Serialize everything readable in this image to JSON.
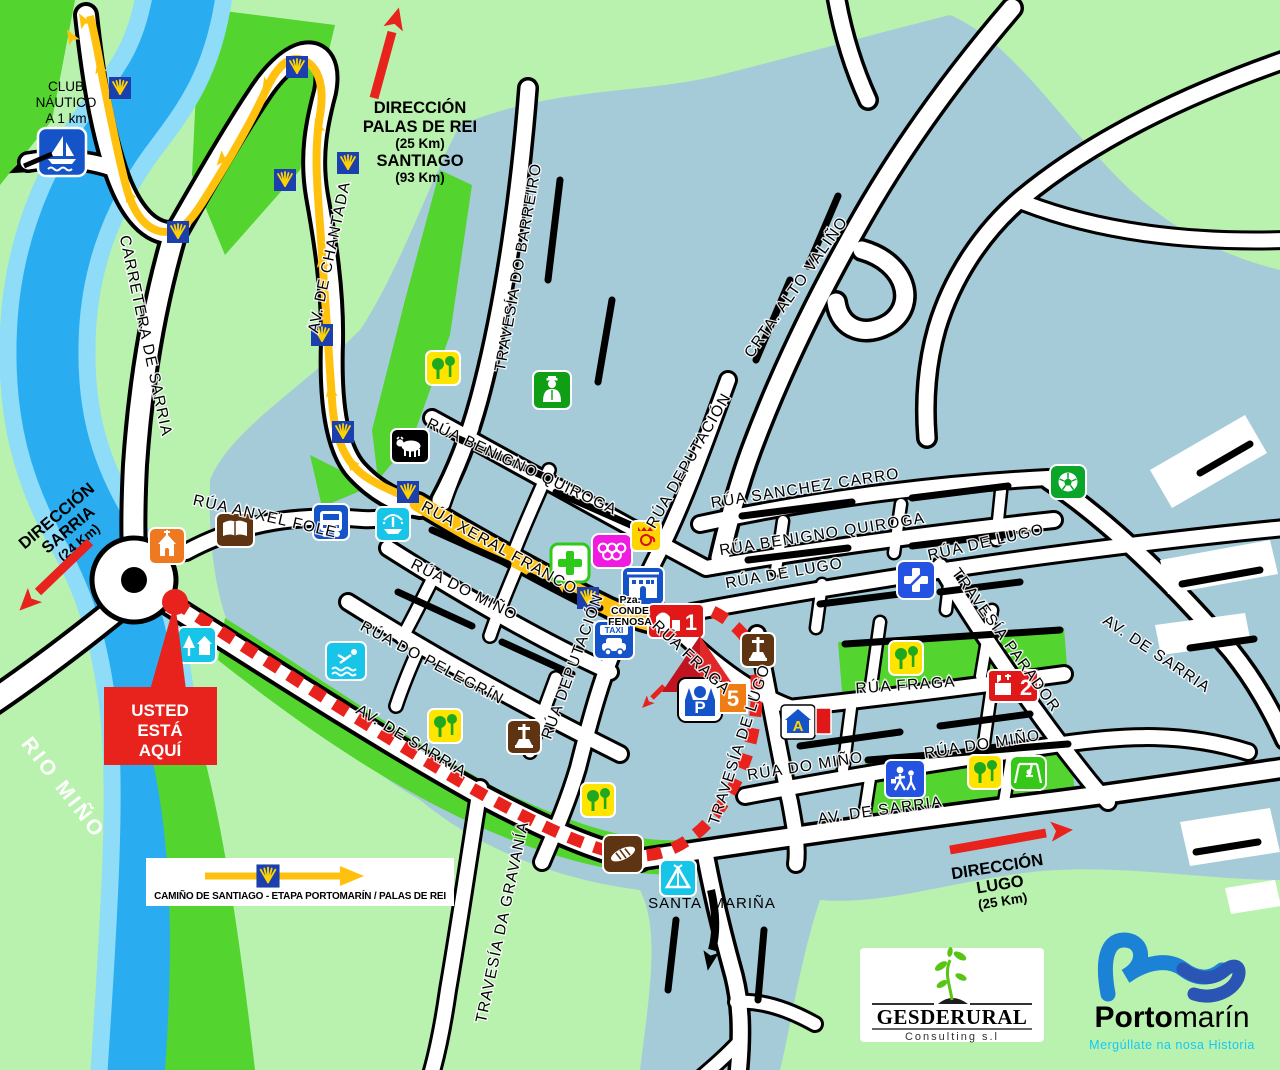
{
  "title": "Mapa de Portomarín",
  "colors": {
    "land": "#b9f1ae",
    "park_green": "#53d42e",
    "urban": "#a6cbd8",
    "river": "#2aadf0",
    "river_edge": "#8edcf8",
    "camino_yellow": "#ffc10e",
    "route_red": "#e8221c"
  },
  "direction_signs": {
    "palas_de_rei": {
      "l1": "DIRECCIÓN",
      "l2": "PALAS DE REI",
      "l3": "(25 Km)",
      "l4": "SANTIAGO",
      "l5": "(93 Km)"
    },
    "sarria": {
      "l1": "DIRECCIÓN",
      "l2": "SARRIA",
      "l3": "(24 Km)"
    },
    "lugo": {
      "l1": "DIRECCIÓN",
      "l2": "LUGO",
      "l3": "(25 Km)"
    }
  },
  "labels": {
    "club_nautico": {
      "l1": "CLUB",
      "l2": "NÁUTICO",
      "l3": "A 1 km"
    },
    "you_are_here": {
      "l1": "USTED",
      "l2": "ESTÁ",
      "l3": "AQUÍ"
    },
    "river": "RIO MIÑO",
    "santa_marina": "SANTA  MARIÑA",
    "plaza": {
      "l1": "Pza.",
      "l2": "CONDE",
      "l3": "FENOSA"
    }
  },
  "streets": {
    "carretera_de_sarria": "CARRETERA DE SARRIA",
    "av_de_chantada": "AV. DE CHANTADA",
    "travesia_do_barreiro": "TRAVESÍA DO BARREIRO",
    "crta_alto_valino": "CRTA. ALTO VALIÑO",
    "rua_benigno_quiroga": "RÚA BENIGNO QUIROGA",
    "rua_deputacion": "RÚA DEPUTACIÓN",
    "rua_sanchez_carro": "RÚA SANCHEZ CARRO",
    "rua_de_lugo": "RÚA DE LUGO",
    "rua_xeral_franco": "RÚA XERAL FRANCO",
    "rua_do_mino": "RÚA DO MIÑO",
    "rua_do_pelegrin": "RÚA DO PELEGRÍN",
    "rua_anxel_fole": "RÚA ANXEL FOLE",
    "rua_fraga": "RÚA FRAGA",
    "travesia_de_lugo": "TRAVESÍA DE LUGO",
    "travesia_parador": "TRAVESÍA PARADOR",
    "travesia_da_gravania": "TRAVESÍA DA GRAVANÍA",
    "av_de_sarria": "AV. DE SARRIA"
  },
  "markers": {
    "taxi": "TAXI",
    "parking_p": "P",
    "number_5": "5",
    "number_1": "1",
    "number_2": "2",
    "albergue_a": "A"
  },
  "legend": {
    "caption": "CAMIÑO DE SANTIAGO  -  ETAPA PORTOMARÍN / PALAS DE REI"
  },
  "logos": {
    "gesderural": {
      "name": "GESDERURAL",
      "subtitle": "Consulting s.l"
    },
    "portomarin": {
      "bold": "Porto",
      "light": "marín",
      "tagline": "Mergúllate na nosa Historia"
    }
  }
}
